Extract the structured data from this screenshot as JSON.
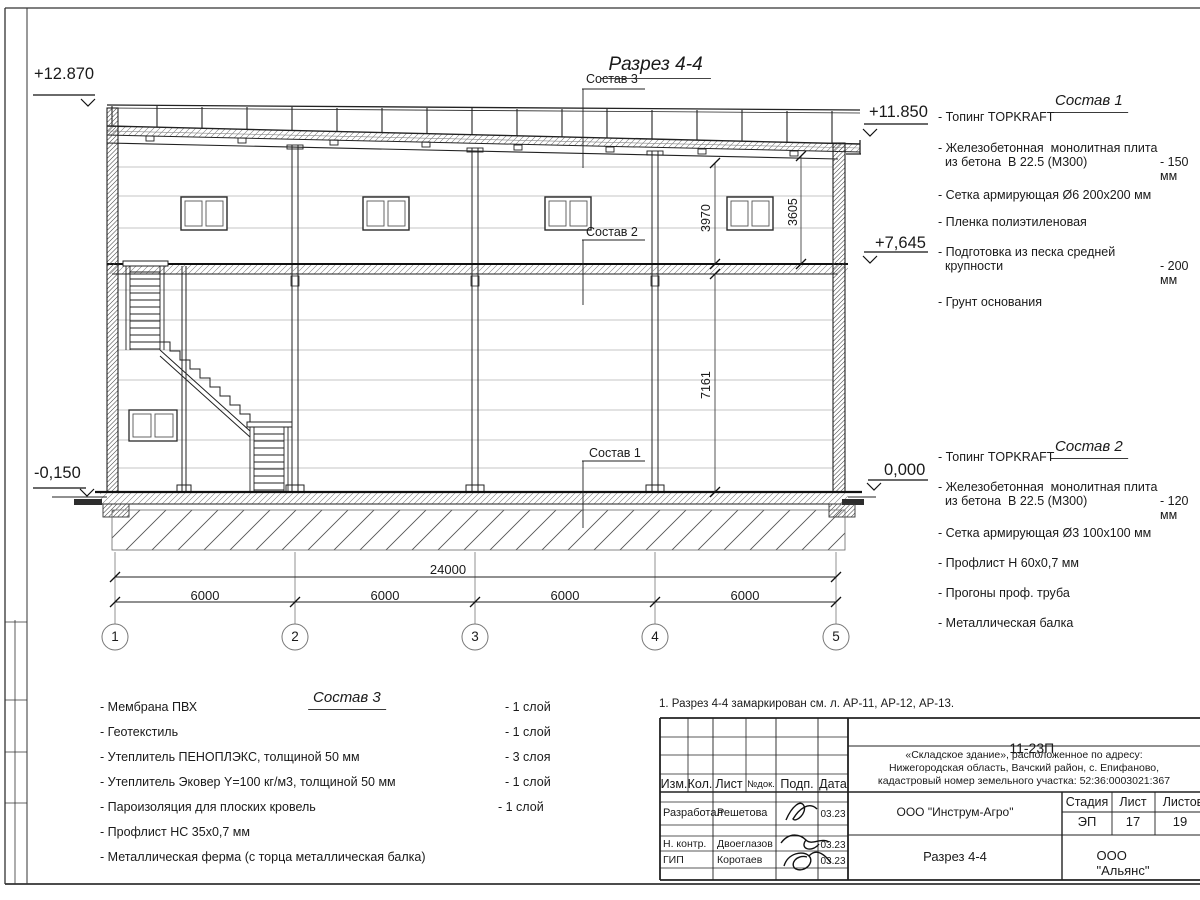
{
  "sheet": {
    "title": "Разрез 4-4",
    "note": "1. Разрез 4-4 замаркирован см. л. АР-11, АР-12, АР-13."
  },
  "section": {
    "elevations": {
      "roof_left": "+12.870",
      "roof_right": "+11.850",
      "floor2": "+7,645",
      "zero": "0,000",
      "ground": "-0,150"
    },
    "dims": {
      "total": "24000",
      "bay1": "6000",
      "bay2": "6000",
      "bay3": "6000",
      "bay4": "6000",
      "h_upper_left": "3970",
      "h_upper_right": "3605",
      "h_lower": "7161"
    },
    "axes": [
      "1",
      "2",
      "3",
      "4",
      "5"
    ],
    "leaders": {
      "l3": "Состав 3",
      "l2": "Состав 2",
      "l1": "Состав 1"
    }
  },
  "sostav1": {
    "title": "Состав 1",
    "items": [
      {
        "text": "- Топинг TOPKRAFT",
        "value": ""
      },
      {
        "text": "- Железобетонная  монолитная плита\n  из бетона  В 22.5 (М300)",
        "value": "- 150 мм"
      },
      {
        "text": "- Сетка армирующая Ø6 200x200 мм",
        "value": ""
      },
      {
        "text": "- Пленка полиэтиленовая",
        "value": ""
      },
      {
        "text": "- Подготовка из песка средней\n  крупности",
        "value": "- 200 мм"
      },
      {
        "text": "- Грунт основания",
        "value": ""
      }
    ]
  },
  "sostav2": {
    "title": "Состав 2",
    "items": [
      {
        "text": "- Топинг TOPKRAFT",
        "value": ""
      },
      {
        "text": "- Железобетонная  монолитная плита\n  из бетона  В 22.5 (М300)",
        "value": "- 120 мм"
      },
      {
        "text": "- Сетка армирующая Ø3 100x100 мм",
        "value": ""
      },
      {
        "text": "- Профлист Н 60х0,7 мм",
        "value": ""
      },
      {
        "text": "- Прогоны проф. труба",
        "value": ""
      },
      {
        "text": "- Металлическая балка",
        "value": ""
      }
    ]
  },
  "sostav3": {
    "title": "Состав 3",
    "items": [
      {
        "text": "- Мембрана ПВХ",
        "value": "- 1 слой"
      },
      {
        "text": "- Геотекстиль",
        "value": "- 1 слой"
      },
      {
        "text": "- Утеплитель ПЕНОПЛЭКС, толщиной 50 мм",
        "value": "- 3 слоя"
      },
      {
        "text": "- Утеплитель Эковер Y=100 кг/м3, толщиной 50 мм",
        "value": "- 1 слой"
      },
      {
        "text": "- Пароизоляция для плоских кровель",
        "value": "- 1 слой"
      },
      {
        "text": "- Профлист НС 35х0,7 мм",
        "value": ""
      },
      {
        "text": "- Металлическая ферма (с торца металлическая балка)",
        "value": ""
      }
    ]
  },
  "titleblock": {
    "code": "11-23П",
    "object": "«Складское здание», расположенное по адресу:\nНижегородская область, Вачский район, с. Епифаново,\nкадастровый номер земельного участка: 52:36:0003021:367",
    "columns": [
      "Изм.",
      "Кол.",
      "Лист",
      "№док.",
      "Подп.",
      "Дата"
    ],
    "rows": [
      {
        "role": "Разработал",
        "name": "Решетова",
        "date": "03.23"
      },
      {
        "role": "Н. контр.",
        "name": "Двоеглазов",
        "date": "03.23"
      },
      {
        "role": "ГИП",
        "name": "Коротаев",
        "date": "03.23"
      }
    ],
    "org": "ООО \"Инструм-Агро\"",
    "stage_label": "Стадия",
    "sheet_label": "Лист",
    "sheets_label": "Листов",
    "stage": "ЭП",
    "sheet_no": "17",
    "sheets_total": "19",
    "drawing_name": "Разрез 4-4",
    "company": "ООО \"Альянс\""
  }
}
